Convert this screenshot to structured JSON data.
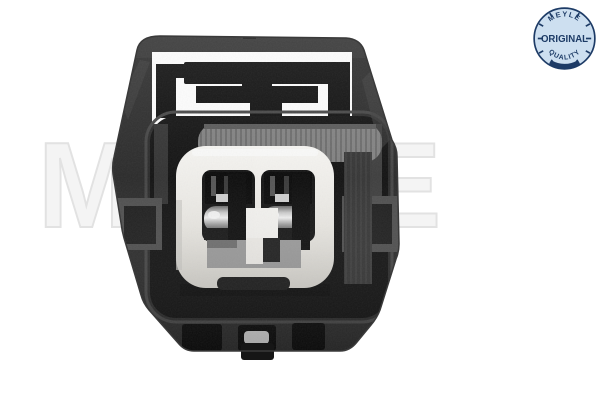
{
  "watermark": {
    "text": "MEYLE"
  },
  "badge": {
    "brand_top": "MEYLE",
    "label": "ORIGINAL",
    "bottom": "QUALITY"
  },
  "product_photo": {
    "alt": "Black two-pin automotive electrical connector housing, front view, with white inner insert, gray seal ring and metal terminals"
  },
  "theme": {
    "page-bg": "#ffffff",
    "watermark-ink": "#e2e2e2",
    "badge-fill": "#cddff0",
    "badge-ink": "#1d3b66",
    "housing": "#2b2b2b",
    "cavity": "#121212",
    "seal-gray": "#818181",
    "insert-white": "#edebe7",
    "metal": "#d9d9d9"
  }
}
